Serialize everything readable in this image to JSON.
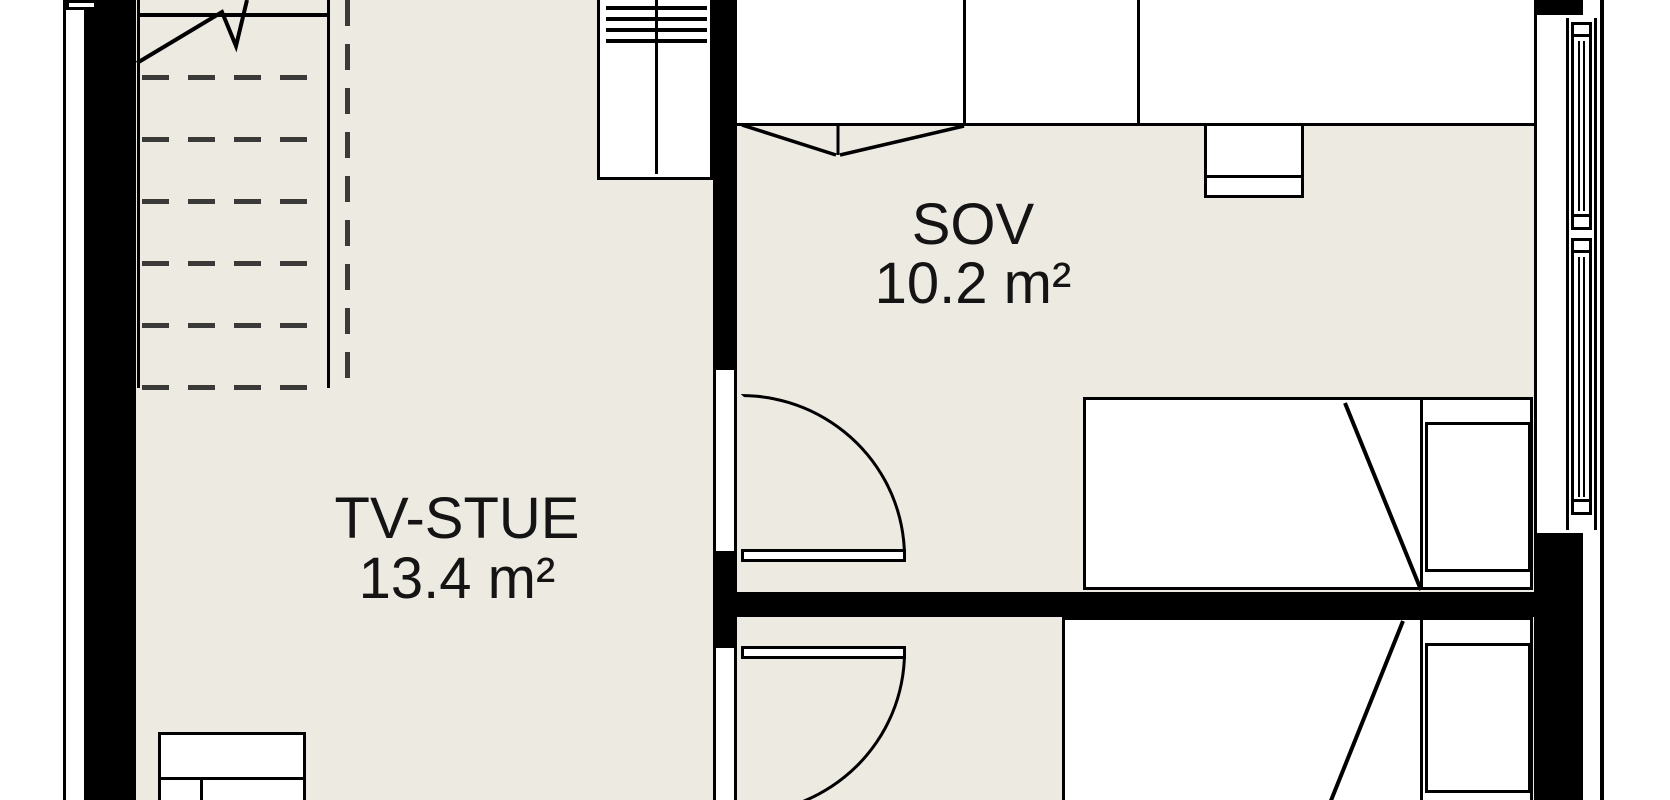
{
  "title": "apartment-floor-plan",
  "rooms": {
    "tv_stue": {
      "name": "TV-STUE",
      "area": "13.4 m²"
    },
    "sov": {
      "name": "SOV",
      "area": "10.2 m²"
    }
  },
  "colors": {
    "background": "#ffffff",
    "floor": "#edeae2",
    "wall": "#000000",
    "stair_dash": "#3a3a3a",
    "label_text": "#141414"
  }
}
